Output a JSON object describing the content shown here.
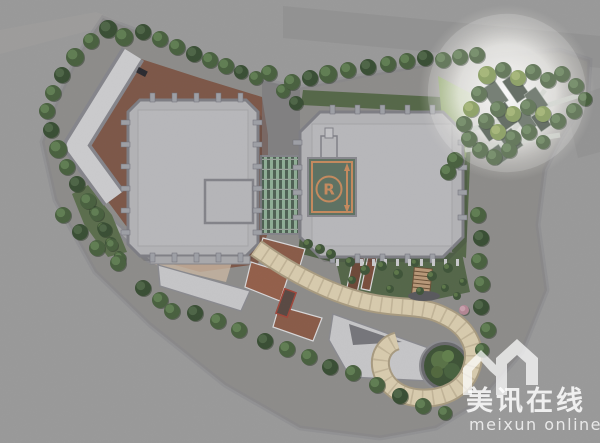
{
  "image": {
    "type": "architectural-site-plan-rendering",
    "view": "aerial-top-down-masterplan"
  },
  "watermark": {
    "brand_cn": "美讯在线",
    "brand_en": "meixun  online",
    "logo_name": "meixun-house-m-logo",
    "text_color": "#ffffff"
  },
  "helipad": {
    "letter": "R",
    "pad_color": "#5f7263",
    "marking_color": "#c58b5f"
  },
  "palette": {
    "background_street": "#9a9a9a",
    "site_ground": "#8e8d8b",
    "plaza_paving": "#7d5849",
    "tower_roof": "#b3b3b6",
    "tower_edge": "#7e7e85",
    "low_roof": "#c2c2c4",
    "atrium_glass_light": "#8fae96",
    "atrium_glass_dark": "#4f6154",
    "walkway_canopy": "#d8cbae",
    "garden_dark": "#55674a",
    "hedge_bright": "#7f9e52",
    "tree_mid": "#4a6140",
    "accent_tree_pink": "#b38794",
    "spotlight_glow": "#ffffff"
  },
  "scene": {
    "spotlight": {
      "cx": 507,
      "cy": 93,
      "r": 88
    },
    "trees": {
      "boundary_nw": [
        [
          108,
          29,
          9,
          0
        ],
        [
          91,
          41,
          8
        ],
        [
          75,
          57,
          9
        ],
        [
          62,
          75,
          8,
          0
        ],
        [
          53,
          93,
          8
        ],
        [
          47,
          111,
          8
        ],
        [
          51,
          130,
          8,
          0
        ],
        [
          58,
          149,
          9
        ],
        [
          67,
          167,
          8
        ],
        [
          77,
          184,
          8,
          0
        ],
        [
          88,
          201,
          8
        ]
      ],
      "west_garden": [
        [
          97,
          214,
          7
        ],
        [
          105,
          230,
          7,
          0
        ],
        [
          112,
          245,
          6
        ],
        [
          120,
          258,
          6
        ]
      ],
      "top_row": [
        [
          124,
          37,
          9
        ],
        [
          143,
          32,
          8,
          0
        ],
        [
          160,
          39,
          8
        ],
        [
          177,
          47,
          8
        ],
        [
          194,
          54,
          8,
          0
        ],
        [
          210,
          60,
          8
        ],
        [
          226,
          66,
          8
        ],
        [
          241,
          72,
          7,
          0
        ],
        [
          256,
          78,
          7
        ],
        [
          269,
          73,
          8
        ],
        [
          283,
          91,
          7
        ],
        [
          296,
          103,
          7,
          0
        ]
      ],
      "north_row": [
        [
          292,
          82,
          8
        ],
        [
          310,
          78,
          8,
          0
        ],
        [
          328,
          74,
          9
        ],
        [
          348,
          70,
          8
        ],
        [
          368,
          67,
          8,
          0
        ],
        [
          388,
          64,
          8
        ],
        [
          407,
          61,
          8
        ],
        [
          425,
          58,
          8,
          0
        ],
        [
          443,
          60,
          8
        ],
        [
          460,
          57,
          8
        ],
        [
          477,
          55,
          8
        ]
      ],
      "ne_garden": [
        [
          487,
          75,
          9,
          2
        ],
        [
          503,
          70,
          8
        ],
        [
          518,
          78,
          8,
          2
        ],
        [
          533,
          72,
          8
        ],
        [
          548,
          80,
          8
        ],
        [
          562,
          74,
          8
        ],
        [
          576,
          86,
          8
        ],
        [
          585,
          99,
          7
        ],
        [
          574,
          111,
          8
        ],
        [
          558,
          121,
          8
        ],
        [
          543,
          114,
          8,
          2
        ],
        [
          528,
          107,
          8
        ],
        [
          513,
          114,
          8,
          2
        ],
        [
          498,
          109,
          8
        ],
        [
          486,
          121,
          8
        ],
        [
          498,
          132,
          8,
          2
        ],
        [
          513,
          138,
          8
        ],
        [
          529,
          132,
          8
        ],
        [
          543,
          142,
          7
        ],
        [
          509,
          150,
          8
        ],
        [
          494,
          157,
          8
        ],
        [
          480,
          150,
          8
        ],
        [
          469,
          139,
          8
        ],
        [
          464,
          124,
          8
        ],
        [
          471,
          109,
          8,
          2
        ],
        [
          479,
          94,
          8
        ],
        [
          455,
          160,
          8
        ],
        [
          448,
          172,
          8
        ]
      ],
      "south_row": [
        [
          63,
          215,
          8
        ],
        [
          80,
          232,
          8,
          0
        ],
        [
          97,
          248,
          8
        ],
        [
          118,
          263,
          8
        ],
        [
          143,
          288,
          8,
          0
        ],
        [
          160,
          300,
          8
        ],
        [
          172,
          311,
          8
        ],
        [
          195,
          313,
          8,
          0
        ],
        [
          218,
          321,
          8
        ],
        [
          239,
          330,
          8
        ],
        [
          265,
          341,
          8,
          0
        ],
        [
          287,
          349,
          8
        ],
        [
          309,
          357,
          8
        ],
        [
          330,
          367,
          8,
          0
        ],
        [
          353,
          373,
          8
        ],
        [
          377,
          385,
          8
        ],
        [
          400,
          396,
          8,
          0
        ],
        [
          423,
          406,
          8
        ],
        [
          445,
          413,
          7
        ]
      ],
      "east_walk": [
        [
          478,
          215,
          8
        ],
        [
          481,
          238,
          8,
          0
        ],
        [
          479,
          261,
          8
        ],
        [
          482,
          284,
          8
        ],
        [
          481,
          307,
          8,
          0
        ],
        [
          488,
          330,
          8
        ],
        [
          482,
          350,
          7
        ]
      ],
      "accents": [
        [
          464,
          310,
          5,
          3
        ]
      ]
    },
    "shrubs": [
      [
        350,
        262,
        5
      ],
      [
        365,
        270,
        5
      ],
      [
        382,
        266,
        5
      ],
      [
        398,
        274,
        5
      ],
      [
        415,
        263,
        4
      ],
      [
        432,
        276,
        5
      ],
      [
        448,
        268,
        5
      ],
      [
        352,
        280,
        4
      ],
      [
        390,
        289,
        4
      ],
      [
        420,
        291,
        4
      ],
      [
        445,
        288,
        4
      ],
      [
        308,
        244,
        5
      ],
      [
        320,
        249,
        5
      ],
      [
        331,
        254,
        5
      ],
      [
        95,
        212,
        6
      ],
      [
        103,
        228,
        6
      ],
      [
        111,
        243,
        6
      ],
      [
        119,
        256,
        5
      ],
      [
        463,
        282,
        4
      ],
      [
        457,
        296,
        4
      ]
    ],
    "planters": [
      [
        495,
        95,
        16,
        24,
        -35
      ],
      [
        516,
        88,
        15,
        26,
        -35
      ],
      [
        536,
        100,
        14,
        22,
        -35
      ],
      [
        505,
        116,
        16,
        24,
        -35
      ],
      [
        526,
        121,
        14,
        20,
        -35
      ],
      [
        489,
        130,
        13,
        19,
        -35
      ],
      [
        511,
        141,
        15,
        21,
        -35
      ],
      [
        541,
        121,
        12,
        18,
        -35
      ],
      [
        498,
        155,
        13,
        17,
        -35
      ]
    ]
  }
}
